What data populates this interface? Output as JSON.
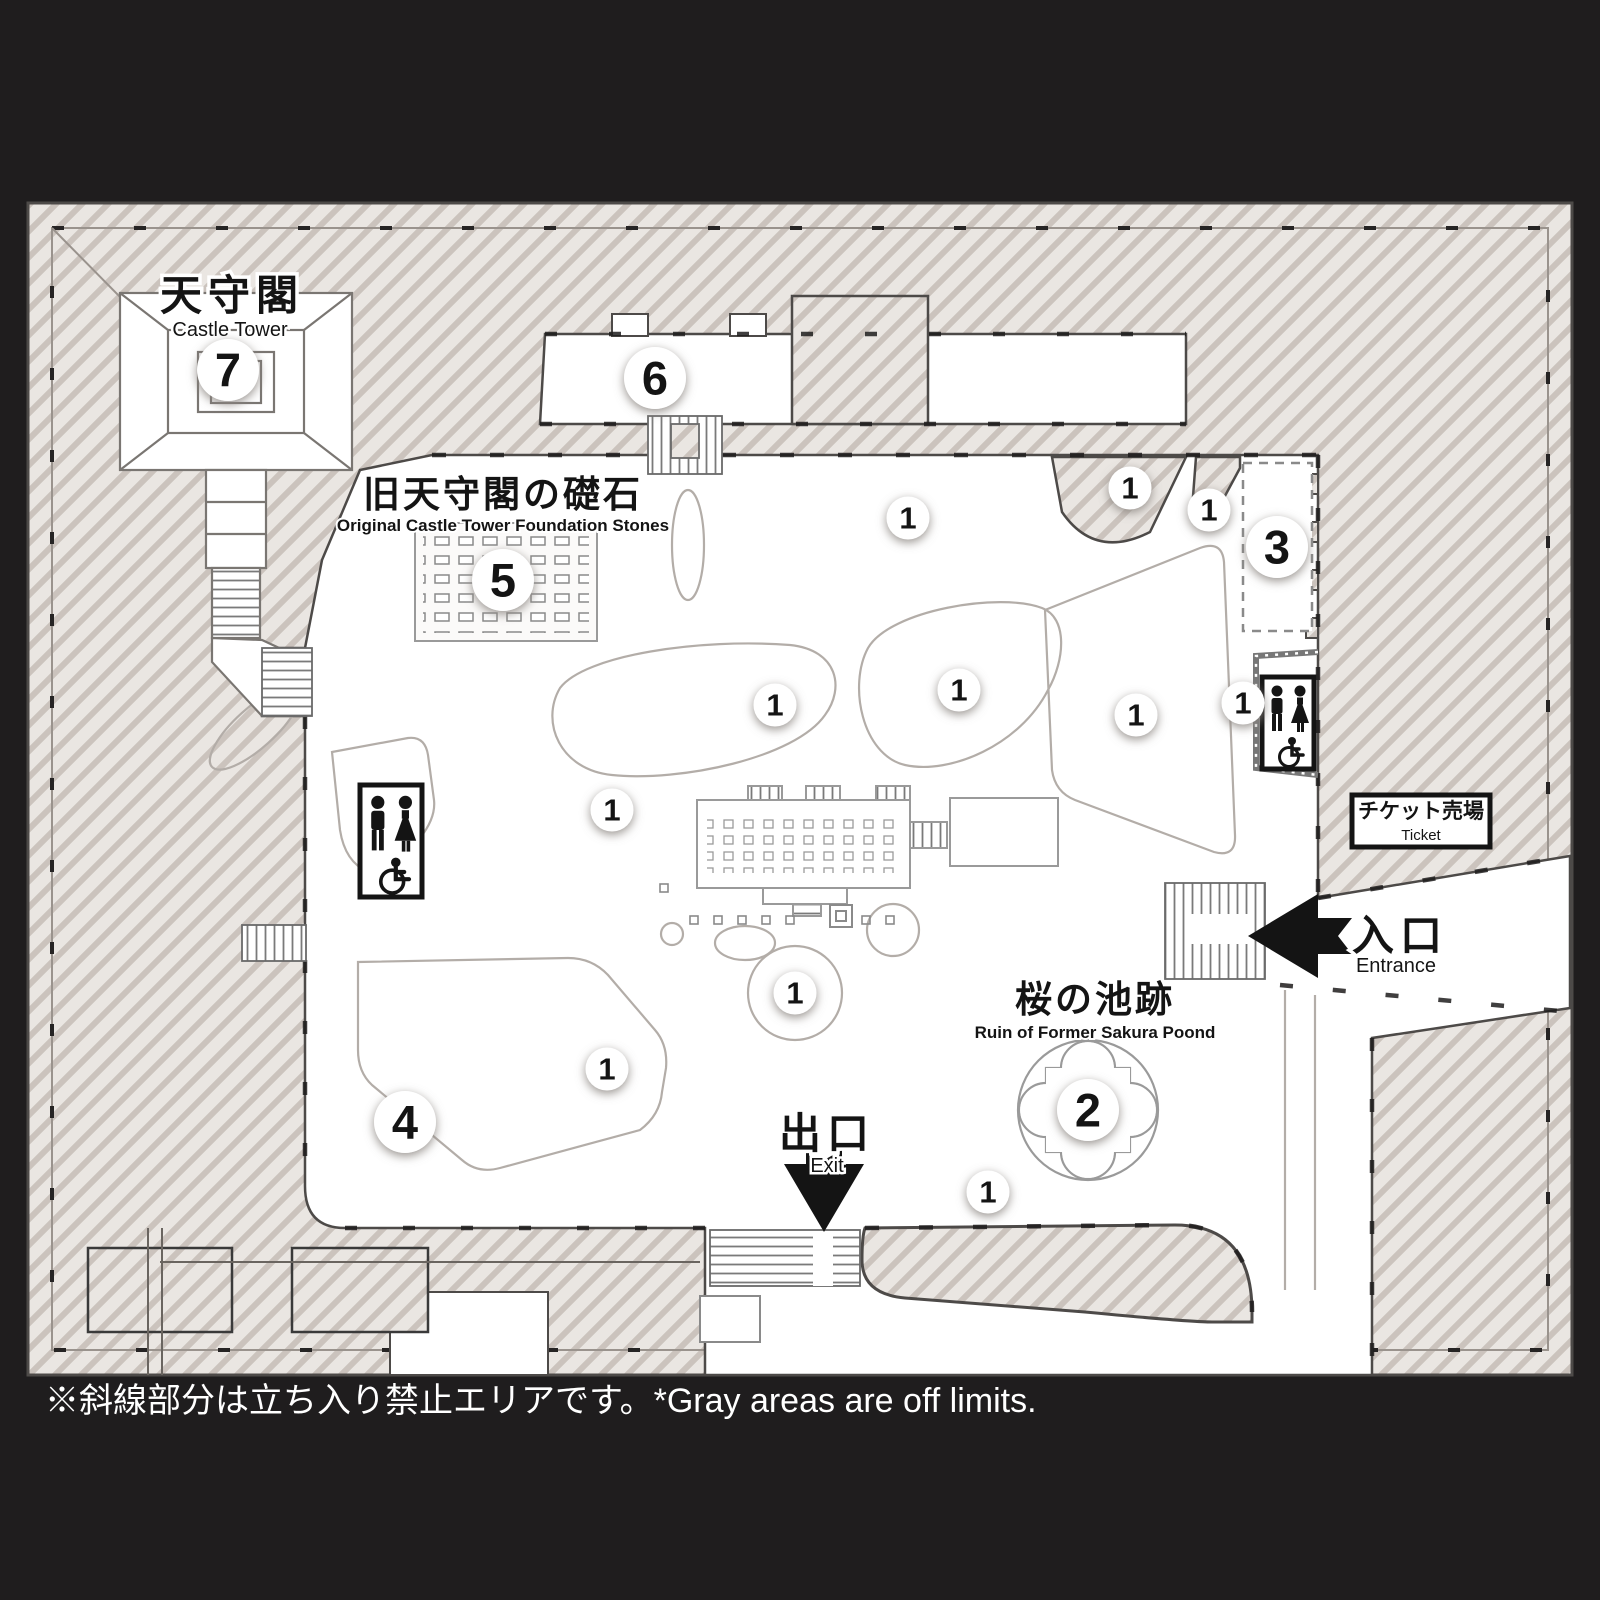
{
  "map": {
    "footer_note": "※斜線部分は立ち入り禁止エリアです。*Gray areas are off limits.",
    "labels": {
      "castle_tower_jp": "天守閣",
      "castle_tower_en": "Castle Tower",
      "foundation_jp": "旧天守閣の礎石",
      "foundation_en": "Original Castle Tower Foundation Stones",
      "pond_jp": "桜の池跡",
      "pond_en": "Ruin of Former Sakura Poond",
      "ticket_jp": "チケット売場",
      "ticket_en": "Ticket",
      "entrance_jp": "入口",
      "entrance_en": "Entrance",
      "exit_jp": "出口",
      "exit_en": "Exit"
    },
    "markers_large": [
      {
        "n": "2",
        "x": 1088,
        "y": 1110
      },
      {
        "n": "3",
        "x": 1277,
        "y": 547
      },
      {
        "n": "4",
        "x": 405,
        "y": 1122
      },
      {
        "n": "5",
        "x": 503,
        "y": 580
      },
      {
        "n": "6",
        "x": 655,
        "y": 378
      },
      {
        "n": "7",
        "x": 228,
        "y": 370
      }
    ],
    "markers_small": [
      {
        "n": "1",
        "x": 908,
        "y": 518
      },
      {
        "n": "1",
        "x": 1130,
        "y": 488
      },
      {
        "n": "1",
        "x": 1209,
        "y": 510
      },
      {
        "n": "1",
        "x": 775,
        "y": 705
      },
      {
        "n": "1",
        "x": 959,
        "y": 690
      },
      {
        "n": "1",
        "x": 1136,
        "y": 715
      },
      {
        "n": "1",
        "x": 1243,
        "y": 703
      },
      {
        "n": "1",
        "x": 612,
        "y": 810
      },
      {
        "n": "1",
        "x": 795,
        "y": 993
      },
      {
        "n": "1",
        "x": 607,
        "y": 1069
      },
      {
        "n": "1",
        "x": 988,
        "y": 1192
      }
    ],
    "icons": {
      "toilet_left": "toilet-wheelchair-icon",
      "toilet_right": "toilet-wheelchair-icon",
      "entrance_arrow": "arrow-left-icon",
      "exit_arrow": "arrow-down-icon"
    },
    "colors": {
      "background": "#1f1d1e",
      "hatch_base": "#eae6e2",
      "hatch_stripe": "#cbc3bd",
      "wall_line": "#4d4a48",
      "walk_area": "#ffffff",
      "garden_path": "#b3ada8",
      "ink": "#141414"
    }
  }
}
